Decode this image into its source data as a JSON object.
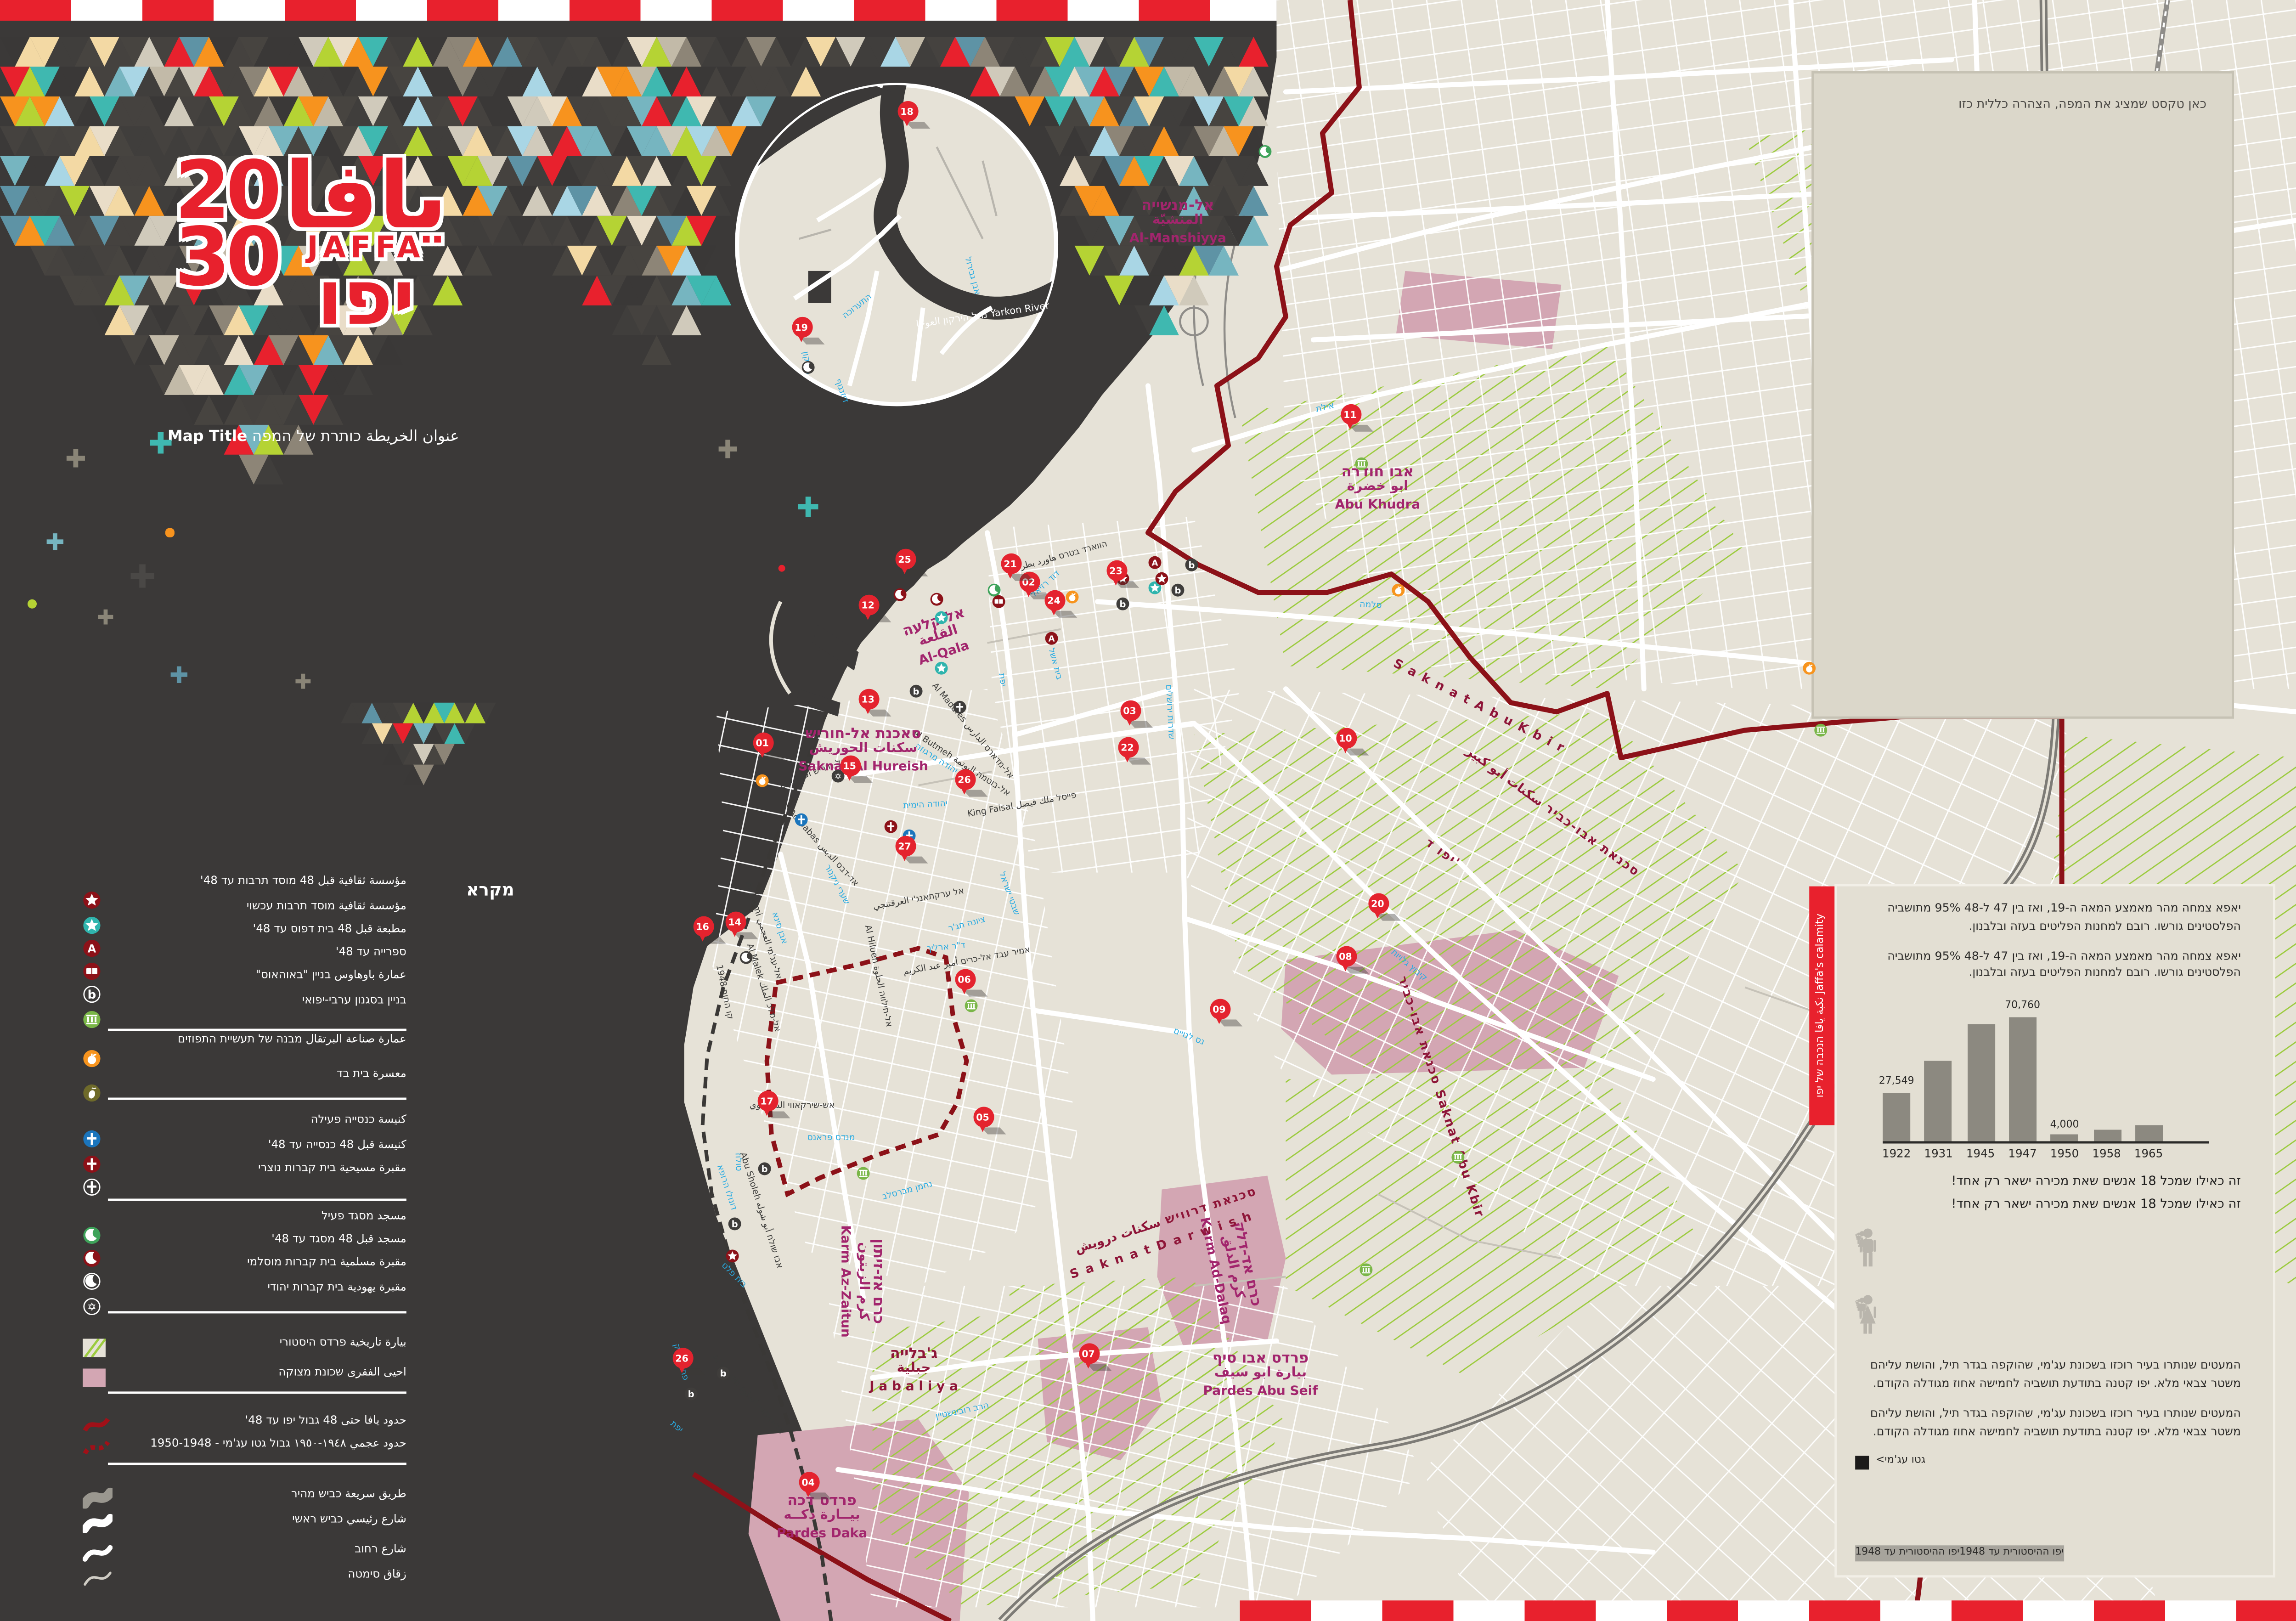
{
  "header": {
    "logo": {
      "twenty": "20",
      "thirty": "30",
      "latin": "JAFFA",
      "arabic": "يافا",
      "hebrew": "יפו"
    },
    "map_title": {
      "rtl_part": "عنوان الخريطة כותרת של המפה",
      "english": "Map Title"
    }
  },
  "note_box": {
    "text": "כאן טקסט שמציג את המפה, הצהרה כללית כזו"
  },
  "legend": {
    "title": "מקרא",
    "items": [
      {
        "kind": "icon",
        "type": "star",
        "style": "darkred",
        "label": "مؤسسة ثقافية قبل 48 מוסד תרבות עד 48'"
      },
      {
        "kind": "icon",
        "type": "star",
        "style": "teal",
        "label": "مؤسسة ثقافية מוסד תרבות עכשוי"
      },
      {
        "kind": "icon",
        "type": "letterA",
        "style": "darkred",
        "label": "مطبعة قبل 48 בית דפוס עד 48'"
      },
      {
        "kind": "icon",
        "type": "book",
        "style": "darkred",
        "label": "ספרייה עד 48'"
      },
      {
        "kind": "icon",
        "type": "letterB",
        "style": "outline",
        "label": "عمارة باوهاوس בניין \"באוהאוס\""
      },
      {
        "kind": "icon",
        "type": "columns",
        "style": "green",
        "label": "בניין בסגנון ערבי-יפואי"
      },
      {
        "kind": "divider"
      },
      {
        "kind": "icon",
        "type": "orange",
        "style": "orange",
        "label": "عمارة صناعة البرتقال מבנה של תעשיית התפוזים"
      },
      {
        "kind": "icon",
        "type": "olive",
        "style": "olive",
        "label": "معسرة בית בד"
      },
      {
        "kind": "divider"
      },
      {
        "kind": "icon",
        "type": "cross",
        "style": "blue",
        "label": "كنيسة כנסייה פעילה"
      },
      {
        "kind": "icon",
        "type": "cross",
        "style": "darkred",
        "label": "كنيسة قبل 48 כנסייה עד 48'"
      },
      {
        "kind": "icon",
        "type": "cross",
        "style": "outline",
        "label": "مقبرة مسيحية בית קברות נוצרי"
      },
      {
        "kind": "divider"
      },
      {
        "kind": "icon",
        "type": "crescent",
        "style": "green",
        "label": "مسجد מסגד פעיל"
      },
      {
        "kind": "icon",
        "type": "crescent",
        "style": "darkred",
        "label": "مسجد قبل 48 מסגד עד 48'"
      },
      {
        "kind": "icon",
        "type": "crescent",
        "style": "outline",
        "label": "مقبرة مسلمية בית קברות מוסלמי"
      },
      {
        "kind": "icon",
        "type": "david",
        "style": "outline",
        "label": "مقبرة يهودية בית קברות יהודי"
      },
      {
        "kind": "divider"
      },
      {
        "kind": "swatch",
        "type": "hatch",
        "label": "بيارة تاريخية פרדס היסטורי"
      },
      {
        "kind": "swatch",
        "type": "pink",
        "label": "احيى الفقرى שכונת מצוקה"
      },
      {
        "kind": "divider"
      },
      {
        "kind": "line",
        "type": "red-solid",
        "label": "حدود يافا حتى 48 גבול יפו עד 48'"
      },
      {
        "kind": "line",
        "type": "red-dash",
        "label": "حدود عجمي ١٩٤٨-١٩٥٠ גבול גטו עג'מי - 1950-1948"
      },
      {
        "kind": "divider"
      },
      {
        "kind": "road",
        "type": "fast",
        "label": "طريق سريعة כביש מהיר"
      },
      {
        "kind": "road",
        "type": "main",
        "label": "شارع رئيسي כביש ראשי"
      },
      {
        "kind": "road",
        "type": "street",
        "label": "شارع רחוב"
      },
      {
        "kind": "road",
        "type": "alley",
        "label": "زقاق סימטה"
      }
    ]
  },
  "panel": {
    "tab": "نكبة يافا הנכבה של יפו Jaffa's calamity",
    "paragraph_top": "יאפא צמחה מהר מאמצע המאה ה-19, ואז בין 47 ל-48 95% מתושביה הפלסטינים גורשו. רובם למחנות הפליטים בעזה ובלבנון.",
    "caption": "זה כאילו שמכל 18 אנשים שאת מכירה ישאר רק אחד!",
    "paragraph_bottom": "המעטים שנותרו בעיר רוכזו בשכונת עג'מי, שהוקפה בגדר תיל, והושת עליהם משטר צבאי מלא. יפו קטנה בתודעת תושביה לחמישה אחוז מגודלה הקודם.",
    "footer": {
      "historic_label": "יפו ההיסטורית עד 1948",
      "ghetto_label": "גטו עג'מי>"
    }
  },
  "chart_data": {
    "type": "bar",
    "categories": [
      "1922",
      "1931",
      "1945",
      "1947",
      "1950",
      "1958",
      "1965"
    ],
    "values": [
      27549,
      45000,
      66000,
      70760,
      4000,
      6500,
      9500
    ],
    "labeled_values": {
      "0": "27,549",
      "3": "70,760",
      "4": "4,000"
    },
    "title": "",
    "xlabel": "",
    "ylabel": "",
    "ylim": [
      0,
      75000
    ],
    "grid": false,
    "bar_color": "#8c8980"
  },
  "pictogram": {
    "row1": 10,
    "row2": 9,
    "highlight_last": true,
    "gray": "#b9b5ac",
    "black": "#1c1b1a"
  },
  "map": {
    "pins": [
      "01",
      "02",
      "03",
      "04",
      "05",
      "06",
      "07",
      "08",
      "09",
      "10",
      "11",
      "12",
      "13",
      "14",
      "15",
      "16",
      "17",
      "18",
      "19",
      "20",
      "21",
      "22",
      "23",
      "24",
      "25",
      "26",
      "27",
      "26"
    ],
    "pois": [
      {
        "type": "crescent",
        "style": "green"
      },
      {
        "type": "crescent",
        "style": "green"
      },
      {
        "type": "crescent",
        "style": "darkred"
      },
      {
        "type": "crescent",
        "style": "darkred"
      },
      {
        "type": "crescent",
        "style": "black"
      },
      {
        "type": "crescent",
        "style": "black"
      },
      {
        "type": "book",
        "style": "darkred"
      },
      {
        "type": "star",
        "style": "teal"
      },
      {
        "type": "star",
        "style": "teal"
      },
      {
        "type": "star",
        "style": "teal"
      },
      {
        "type": "star",
        "style": "darkred"
      },
      {
        "type": "star",
        "style": "darkred"
      },
      {
        "type": "star",
        "style": "darkred"
      },
      {
        "type": "letterA",
        "style": "darkred"
      },
      {
        "type": "letterA",
        "style": "darkred"
      },
      {
        "type": "letterB",
        "style": "black"
      },
      {
        "type": "letterB",
        "style": "black"
      },
      {
        "type": "letterB",
        "style": "black"
      },
      {
        "type": "letterB",
        "style": "black"
      },
      {
        "type": "letterB",
        "style": "black"
      },
      {
        "type": "letterB",
        "style": "black"
      },
      {
        "type": "letterB",
        "style": "black"
      },
      {
        "type": "letterB",
        "style": "black"
      },
      {
        "type": "cross",
        "style": "black"
      },
      {
        "type": "cross",
        "style": "blue"
      },
      {
        "type": "cross",
        "style": "blue"
      },
      {
        "type": "cross",
        "style": "darkred"
      },
      {
        "type": "david",
        "style": "black"
      },
      {
        "type": "orange",
        "style": "orange"
      },
      {
        "type": "orange",
        "style": "orange"
      },
      {
        "type": "orange",
        "style": "orange"
      },
      {
        "type": "orange",
        "style": "orange"
      },
      {
        "type": "columns",
        "style": "green"
      },
      {
        "type": "columns",
        "style": "green"
      },
      {
        "type": "columns",
        "style": "green"
      },
      {
        "type": "columns",
        "style": "green"
      },
      {
        "type": "columns",
        "style": "green"
      },
      {
        "type": "columns",
        "style": "green"
      }
    ],
    "district_labels": [
      {
        "he": "אל-מנשייה",
        "ar": "المنشيّة",
        "en": "Al-Manshiyya"
      },
      {
        "he": "אבו חודרה",
        "ar": "ابو خضرة",
        "en": "Abu Khudra"
      },
      {
        "he": "אל קלעה",
        "ar": "القلعة",
        "en": "Al-Qala"
      },
      {
        "he": "סאכנת אל-חוריש",
        "ar": "سكنات الحوريش",
        "en": "Saknat Al Hureish"
      },
      {
        "he": "פרדס דכה",
        "ar": "بيــارة دكــه",
        "en": "Pardes Daka"
      },
      {
        "he": "פרדס אבו סיף",
        "ar": "بيارة ابو سيف",
        "en": "Pardes Abu Seif"
      },
      {
        "he": "כרם אז-זיתון",
        "ar": "كرم الزيتون",
        "en": "Karm Az-Zaitun"
      },
      {
        "he": "כרם אד-דלק",
        "ar": "كرم الدلق",
        "en": "Karm Ad-Dalaq"
      },
      {
        "he": "ג'בלייה",
        "ar": "جبلية",
        "en": "J a b a l i y a"
      }
    ],
    "boundary_labels": [
      "S a k n a t   A b u   K b i r",
      "סכנאת אבו-כביר سكنات أبو كبير",
      "יפו ד'",
      "סכנאת אבו-כביר Saknat Abu Kbir",
      "סכנאת דרוויש سكنات درويش",
      "S a k n a t   D a r w i s h"
    ],
    "street_labels": [
      {
        "text": "אילת",
        "color": "blue"
      },
      {
        "text": "סלמה",
        "color": "blue"
      },
      {
        "text": "שדרות ירושלים",
        "color": "blue"
      },
      {
        "text": "יפת",
        "color": "blue"
      },
      {
        "text": "יפת",
        "color": "blue"
      },
      {
        "text": "קיבוץ גלויות",
        "color": "blue"
      },
      {
        "text": "נס לגויים",
        "color": "blue"
      },
      {
        "text": "יהודה הימית",
        "color": "blue"
      },
      {
        "text": "דוד רזיאל",
        "color": "blue"
      },
      {
        "text": "שערי ניקנור",
        "color": "blue"
      },
      {
        "text": "אבן סינא",
        "color": "blue"
      },
      {
        "text": "יהודה מרגוזה",
        "color": "blue"
      },
      {
        "text": "בית אשל",
        "color": "blue"
      },
      {
        "text": "שבטי ישראל",
        "color": "blue"
      },
      {
        "text": "ציונה תג'ר",
        "color": "blue"
      },
      {
        "text": "ד\"ר ארליך",
        "color": "blue"
      },
      {
        "text": "נחמן מברסלב",
        "color": "blue"
      },
      {
        "text": "מנדס פראנס",
        "color": "blue"
      },
      {
        "text": "טולוז",
        "color": "blue"
      },
      {
        "text": "דונולו הרופא",
        "color": "blue"
      },
      {
        "text": "בית פלט",
        "color": "blue"
      },
      {
        "text": "הרב רובינשטיין",
        "color": "blue"
      },
      {
        "text": "פחד יצחק",
        "color": "blue"
      },
      {
        "text": "התערוכה",
        "color": "blue"
      },
      {
        "text": "הירקון",
        "color": "blue"
      },
      {
        "text": "דיזנגוף",
        "color": "blue"
      },
      {
        "text": "אבן גבירול",
        "color": "blue"
      },
      {
        "text": "Al Madares אל-מדארס الدارس",
        "color": "black"
      },
      {
        "text": "Al Butmeh אל-בוטמה البوتمة",
        "color": "black"
      },
      {
        "text": "Ad Dabas אד-דבס الدبس",
        "color": "black"
      },
      {
        "text": "King Faisal פייסל ملك فيصل",
        "color": "black"
      },
      {
        "text": "Al Ajami אל-עג'מי العجمي",
        "color": "black"
      },
      {
        "text": "Al Malek אל-מלכ الملك",
        "color": "black"
      },
      {
        "text": "Al Hilueh אל-חילווה الحلوة",
        "color": "black"
      },
      {
        "text": "Al Hilueh אל-חילווה الحلوة",
        "color": "black"
      },
      {
        "text": "אל ערקתאנג'י العرقتنجي",
        "color": "black"
      },
      {
        "text": "אמיר עבד אל-כרים أمير عبد الكريم",
        "color": "black"
      },
      {
        "text": "אש-שירקאווי الشرقاوي",
        "color": "black"
      },
      {
        "text": "Abu Sholeh אבו שולח أبو شوله",
        "color": "black"
      },
      {
        "text": "אל-חוריש الحوريش",
        "color": "black"
      },
      {
        "text": "הווארד בטרס هاورد بطرس",
        "color": "black"
      },
      {
        "text": "קו החוף 1948",
        "color": "black"
      },
      {
        "text": "נחל הירקון العوجا Yarkon River",
        "color": "white"
      }
    ]
  },
  "colors": {
    "accent_red": "#e8212d",
    "dark_bg": "#3b3938",
    "land": "#e6e2d7",
    "boundary_red": "#8c1118",
    "district_magenta": "#a2256d",
    "boundary_maroon": "#8e1538",
    "street_blue": "#29abe2",
    "hatch_green": "#9ccb3f",
    "pink_zone": "#d3a6b3",
    "teal": "#2fb4ad",
    "green": "#3ea35a",
    "columns_green": "#7ab648",
    "orange": "#f7941e",
    "olive": "#6e6a2a",
    "cross_blue": "#1b75bc",
    "bar_gray": "#8c8980",
    "mosaic_palette": [
      "#e8212d",
      "#f7931e",
      "#b5d334",
      "#3fb8b0",
      "#a9d6e5",
      "#e9ddc8",
      "#c2baa8",
      "#8d8577",
      "#f3d9a4",
      "#76b5c0",
      "#d0cabb",
      "#5e93a5"
    ]
  }
}
